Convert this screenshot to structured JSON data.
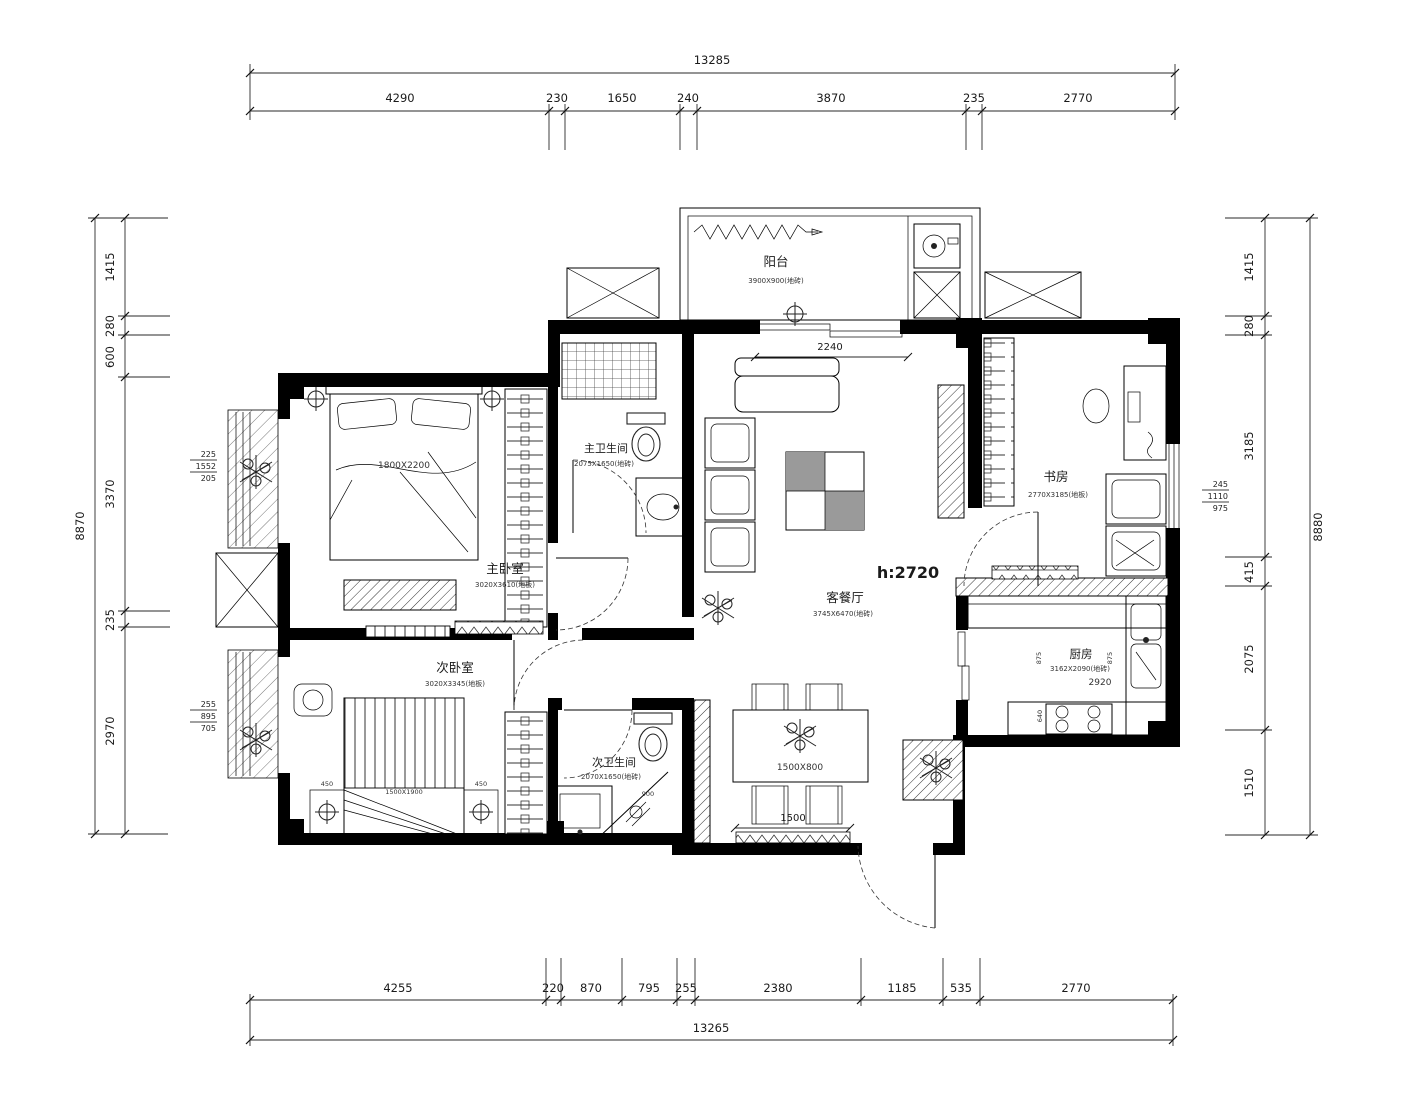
{
  "d": {
    "top": {
      "total": "13285",
      "seg": [
        "4290",
        "230",
        "1650",
        "240",
        "3870",
        "235",
        "2770"
      ]
    },
    "bottom": {
      "total": "13265",
      "seg": [
        "4255",
        "220",
        "870",
        "795",
        "255",
        "2380",
        "1185",
        "535",
        "2770"
      ]
    },
    "left": {
      "total": "8870",
      "seg": [
        "1415",
        "280",
        "600",
        "3370",
        "235",
        "2970"
      ]
    },
    "right": {
      "total": "8880",
      "seg": [
        "1415",
        "280",
        "3185",
        "415",
        "2075",
        "1510"
      ]
    }
  },
  "r": {
    "balcony": {
      "n": "阳台",
      "s": "3900X900(地砖)"
    },
    "mbr": {
      "n": "主卧室",
      "s": "3020X3610(地板)"
    },
    "sbr": {
      "n": "次卧室",
      "s": "3020X3345(地板)"
    },
    "mbath": {
      "n": "主卫生间",
      "s": "2075X1650(地砖)"
    },
    "sbath": {
      "n": "次卫生间",
      "s": "2070X1650(地砖)"
    },
    "living": {
      "n": "客餐厅",
      "s": "3745X6470(地砖)"
    },
    "study": {
      "n": "书房",
      "s": "2770X3185(地板)"
    },
    "kitchen": {
      "n": "厨房",
      "s": "3162X2090(地砖)",
      "d": "2920"
    }
  },
  "a": {
    "h": "h:2720",
    "bed1": "1800X2200",
    "bed2": "1500X1900",
    "ns1": "450",
    "ns2": "450",
    "table": "1500X800",
    "tdim": "1500",
    "open": "2240",
    "k875a": "875",
    "k875b": "875",
    "k640": "640",
    "shower": "900"
  },
  "w": {
    "l1": [
      "225",
      "1552",
      "205"
    ],
    "l2": [
      "255",
      "895",
      "705"
    ],
    "r1": [
      "245",
      "1110",
      "975"
    ]
  }
}
